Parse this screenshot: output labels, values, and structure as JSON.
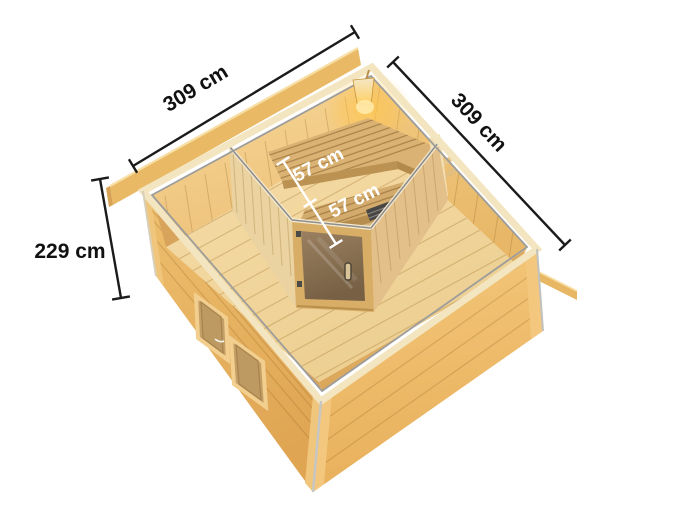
{
  "annotations": {
    "front_width_label": "309 cm",
    "side_depth_label": "309 cm",
    "wall_height_label": "229 cm",
    "bench_depth_upper_label": "57 cm",
    "bench_depth_lower_label": "57 cm"
  },
  "colors": {
    "background": "#ffffff",
    "dimension_line": "#1b1b1b",
    "bench_dimension_line": "#ffffff",
    "wood_exterior_light": "#eec06f",
    "wood_exterior_dark": "#e0a756",
    "wood_interior_bright": "#f6d797",
    "floor_wood": "#f3d8a2",
    "bench_wood": "#d9b172",
    "sauna_wall_pale": "#ead3a0",
    "door_frame": "#d8ad66",
    "door_glass_bronze": "#8d7355",
    "aluminum_strip": "#8e8e8c",
    "lamp_glow": "#ffc04a",
    "heater_dark": "#474644"
  }
}
